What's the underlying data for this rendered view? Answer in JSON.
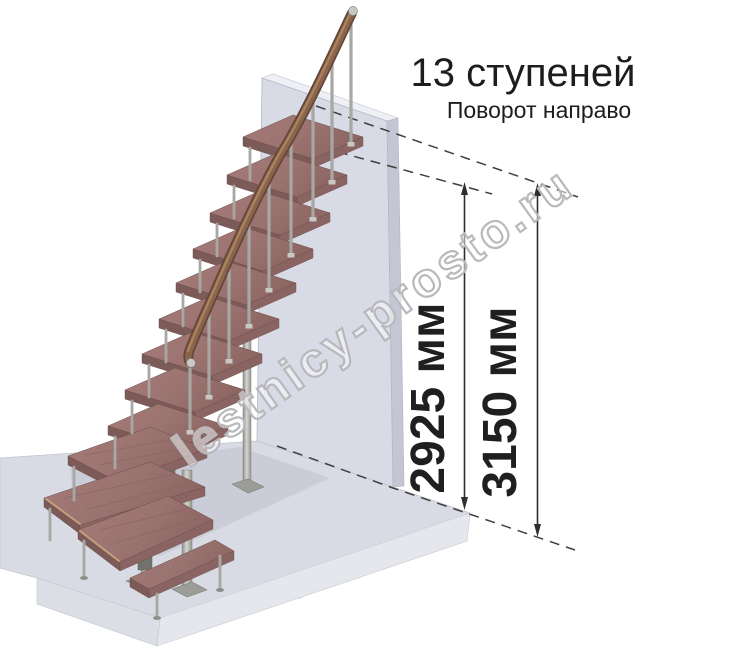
{
  "header": {
    "title": "13 ступеней",
    "subtitle": "Поворот направо"
  },
  "dimensions": [
    {
      "id": "height-to-top-step",
      "label": "2925 мм"
    },
    {
      "id": "total-height",
      "label": "3150 мм"
    }
  ],
  "watermark": {
    "text": "lestnicy-prosto.ru"
  },
  "scene": {
    "steps_total": 13,
    "turn_direction": "направо",
    "colors": {
      "tread_top": "#9b7370",
      "tread_front": "#7b5a58",
      "handrail": "#8a654c",
      "metal": "#a9a9a5",
      "wall": "#d8dae5",
      "floor": "#d9dbe4",
      "dimension_ink": "#2e2e2e",
      "watermark_outline": "#b9b9bd",
      "background": "#ffffff"
    }
  }
}
